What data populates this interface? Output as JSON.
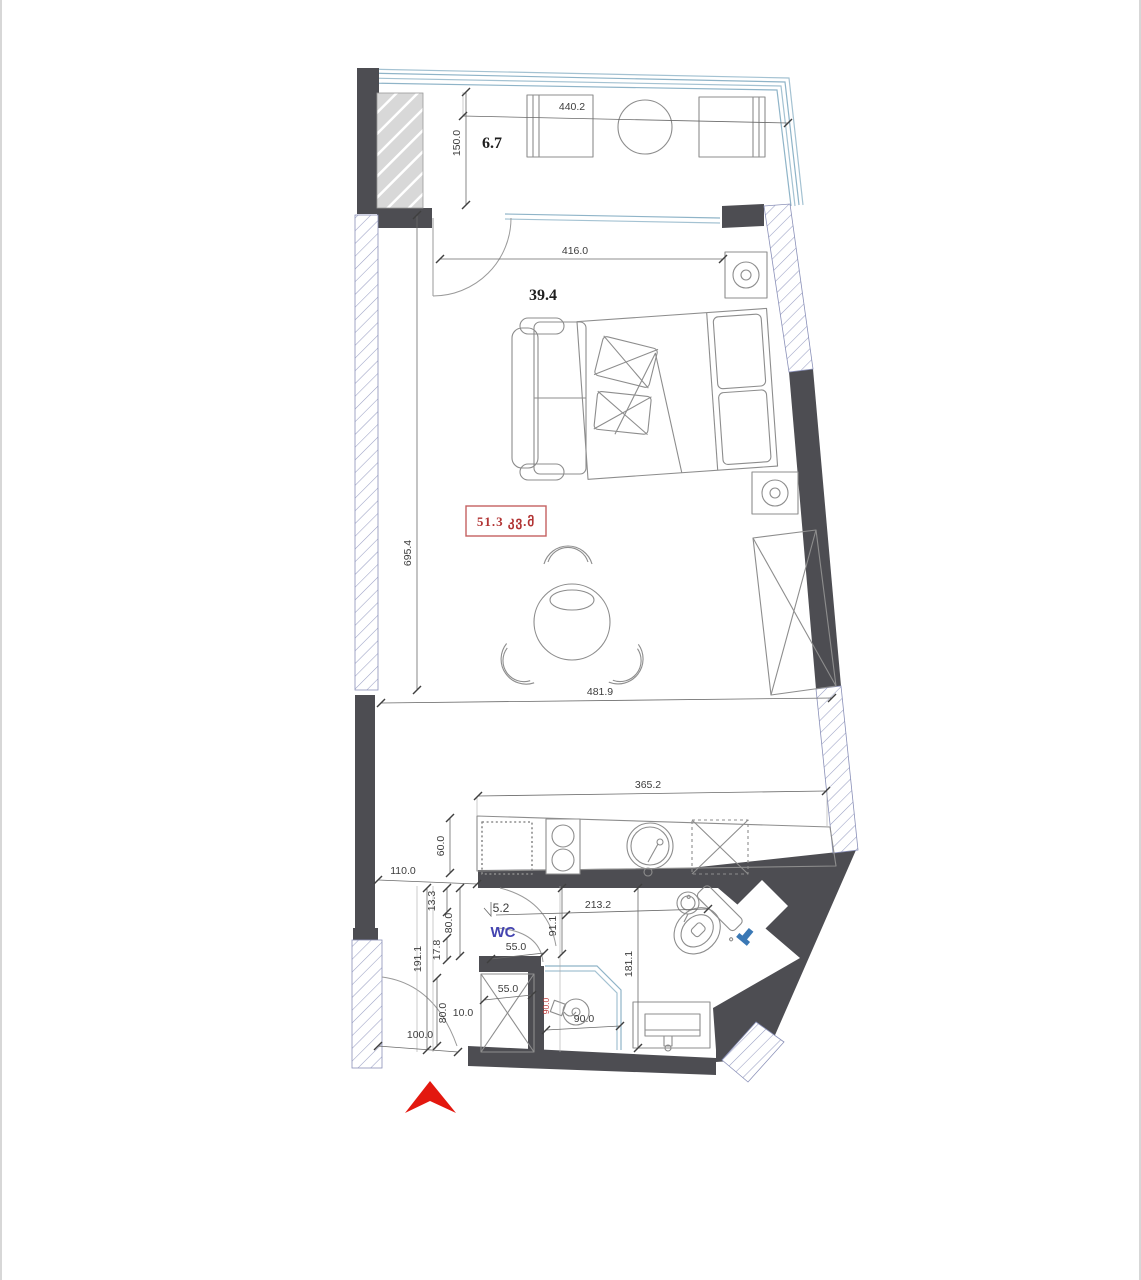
{
  "areas": {
    "balcony": "6.7",
    "living": "39.4",
    "wc_area": "5.2",
    "wc_name": "WC",
    "total_area": "51.3 კვ.მ"
  },
  "dims": {
    "d440": "440.2",
    "d150": "150.0",
    "d416": "416.0",
    "d695": "695.4",
    "d481": "481.9",
    "d365": "365.2",
    "d60": "60.0",
    "d110": "110.0",
    "d13": "13.3",
    "d80a": "80.0",
    "d17": "17.8",
    "d191": "191.1",
    "d55a": "55.0",
    "d91": "91.1",
    "d213": "213.2",
    "d181": "181.1",
    "d55b": "55.0",
    "d80b": "80.0",
    "d10": "10.0",
    "d100": "100.0",
    "d90": "90.0",
    "d90r": "90.0"
  },
  "colors": {
    "wall": "#4d4d52",
    "hatch_line": "#8a90b8",
    "glass": "#a4c2d2",
    "dimension_text": "#3d3d3d",
    "area_text": "#1f1f1f",
    "total_red": "#b23434",
    "wc_blue": "#4444b0",
    "north_arrow_red": "#e3180f"
  }
}
